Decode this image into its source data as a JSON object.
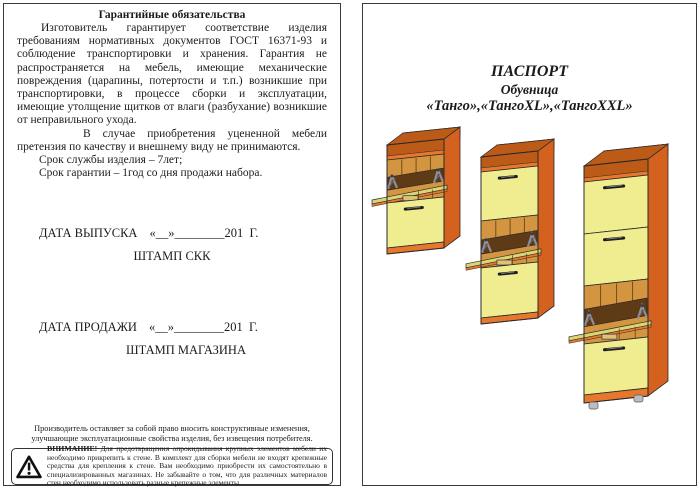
{
  "colors": {
    "orange": "#E8772E",
    "orange-dark": "#D4621E",
    "orange-deep": "#BC5A17",
    "yellow": "#EFED8F",
    "yellow-dark": "#D9D474",
    "amber": "#D3953F",
    "brown": "#5E3B16",
    "metal": "#8F8F9E",
    "outline": "#2A2A2A"
  },
  "icons": {
    "warning_icon": "triangle-exclamation"
  },
  "warranty_page": {
    "title": "Гарантийные обязательства",
    "paragraph1": "Изготовитель гарантирует соответствие изделия требованиям нормативных документов ГОСТ 16371-93 и соблюдение транспортировки и хранения.    Гарантия не распространяется на мебель, имеющие механические повреждения (царапины, потертости и т.п.) возникшие при транспортировки, в процессе сборки и эксплуатации, имеющие утолщение щитков от влаги (разбухание) возникшие от неправильного ухода.",
    "paragraph2": "В случае приобретения уцененной мебели претензия по качеству и внешнему виду не принимаются.",
    "service_life": "Срок службы изделия – 7лет;",
    "warranty_term": "Срок гарантии – 1год со дня продажи набора.",
    "date_issue_label": "ДАТА ВЫПУСКА",
    "date_issue_value": "«__»________201  Г.",
    "stamp_skk": "ШТАМП СКК",
    "date_sale_label": "ДАТА ПРОДАЖИ",
    "date_sale_value": "«__»________201  Г.",
    "stamp_shop": "ШТАМП МАГАЗИНА",
    "manufacturer_note": "Производитель оставляет за собой право вносить конструктивные изменения, улучшающие эксплуатационные свойства изделия, без извещения потребителя.",
    "warning_label": "ВНИМАНИЕ!",
    "warning_text": " Для предотвращения опрокидывания крупных элементов мебели их необходимо прикрепить к стене. В комплект для сборки мебели не входят крепежные средства для крепления к стене. Вам необходимо приобрести их самостоятельно в специализированных магазинах. Не забывайте о том, что для различных материалов стен необходимо использовать разные крепежные элементы."
  },
  "passport_page": {
    "title": "ПАСПОРТ",
    "subtitle": "Обувница",
    "models": "«Танго»,«ТангоXL»,«ТангоXXL»"
  }
}
